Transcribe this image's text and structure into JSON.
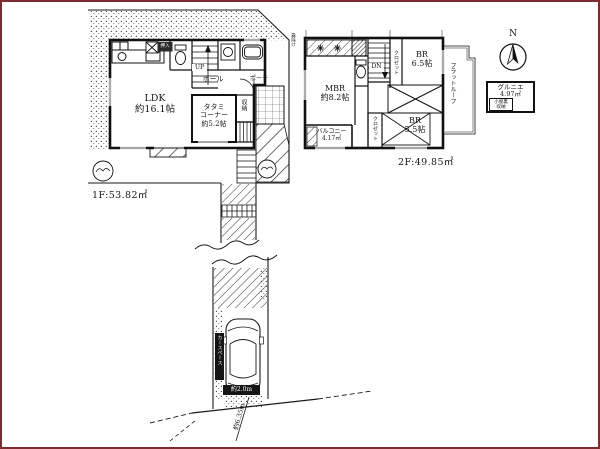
{
  "colors": {
    "ink": "#1a1a1a",
    "frame": "#7c2b2f",
    "paper": "#ffffff"
  },
  "floor1": {
    "area": "1F:53.82㎡",
    "ldk": "LDK\n約16.1帖",
    "tatami": "タタミ\nコーナー\n約5.2帖",
    "hall": "ホール",
    "up": "UP",
    "storage": "収納",
    "oshiire": "押入",
    "porch": "ポーチ"
  },
  "floor2": {
    "area": "2F:49.85㎡",
    "mbr": "MBR\n約8.2帖",
    "br1": "BR\n6.5帖",
    "br2": "BR\n5.5帖",
    "balcony": "バルコニー\n4.17㎡",
    "dn": "DN",
    "closet1": "クロゼット",
    "closet2": "クロゼット",
    "flat_roof": "フラットルーフ",
    "canopy": "霧除け"
  },
  "site": {
    "road_width": "約6.35m",
    "car_space": "カースペース",
    "car_dim": "約2.0m"
  },
  "compass": {
    "north": "N"
  },
  "legend": {
    "text": "グルニエ\n4.97㎡",
    "note": "小屋裏\n収納"
  }
}
